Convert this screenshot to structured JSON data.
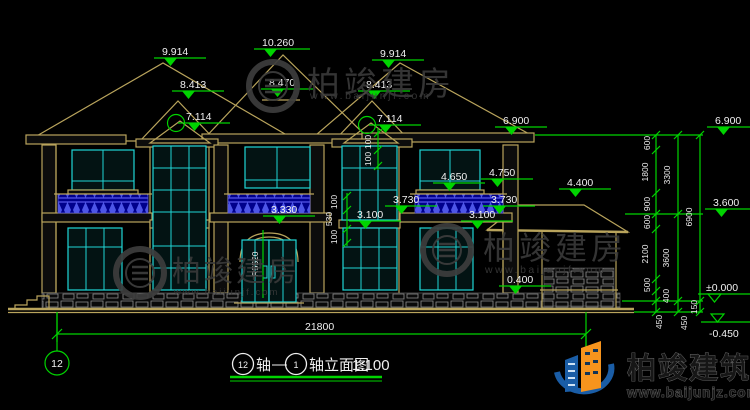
{
  "drawing": {
    "levels": [
      "9.914",
      "10.260",
      "9.914",
      "8.413",
      "8.470",
      "8.413",
      "7.114",
      "7.114",
      "6.900",
      "4.650",
      "4.750",
      "4.400",
      "3.730",
      "3.730",
      "3.330",
      "3.100",
      "3.100",
      "0.400"
    ],
    "right_levels": [
      "6.900",
      "3.600",
      "±0.000",
      "-0.450"
    ],
    "right_chain": {
      "col1": [
        "600",
        "1800",
        "900",
        "600",
        "2100",
        "500",
        "400",
        "450"
      ],
      "col2": [
        "3300",
        "3600",
        "150",
        "450"
      ],
      "col3": [
        "6900"
      ]
    },
    "vertical_dims": {
      "win_top": [
        "100",
        "100"
      ],
      "mid": [
        "100",
        "530",
        "100"
      ]
    },
    "radius_label": "R5520",
    "overall_width": "21800",
    "axis_bubble": "12",
    "title": {
      "axis_start": "12",
      "axis_text": "轴",
      "dash": "—",
      "axis_end": "1",
      "name": "轴立面图",
      "scale": "1:100"
    }
  },
  "watermark": {
    "name": "柏竣建房",
    "url": "www.baijunjf.com"
  },
  "brand": {
    "name": "柏竣建筑",
    "url": "www.baijunjz.com"
  },
  "colors": {
    "line": "#b9a45c",
    "dim_green": "#00d400",
    "window_cyan": "#1fd6d6",
    "railing_blue": "#2a2ac8",
    "text": "#f0f0f0",
    "watermark": "#3d3d3d",
    "brand_blue": "#1a5da6",
    "brand_orange": "#f7941d"
  }
}
